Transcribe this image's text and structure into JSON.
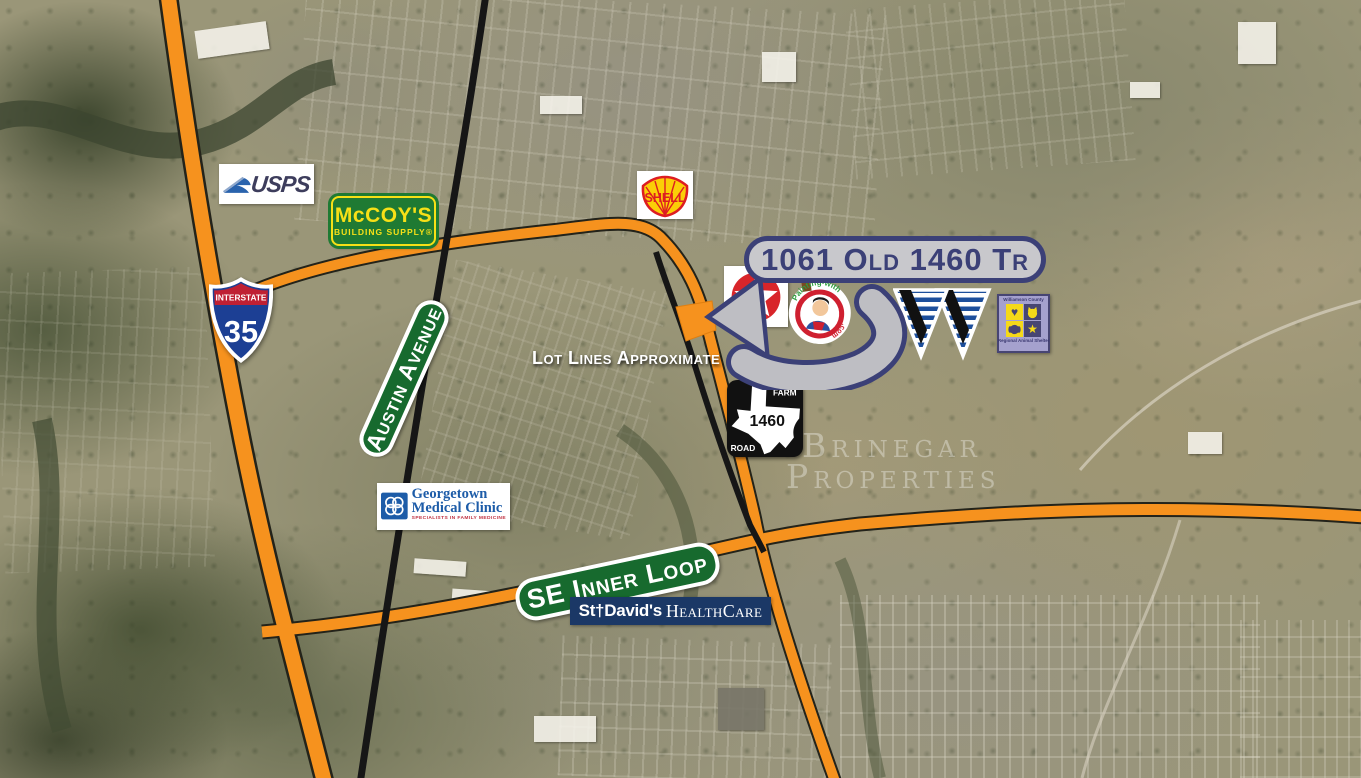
{
  "callout": {
    "label": "1061 Old 1460 Tr"
  },
  "annotations": {
    "lot_lines": "Lot Lines Approximate",
    "watermark_line1": "Brinegar",
    "watermark_line2": "Properties"
  },
  "road_signs": {
    "interstate_35": {
      "header": "INTERSTATE",
      "number": "35"
    },
    "farm_road_1460": {
      "top": "FARM",
      "number": "1460",
      "bottom": "ROAD"
    },
    "austin_avenue": {
      "label": "Austin Avenue"
    },
    "se_inner_loop": {
      "label": "SE Inner Loop"
    }
  },
  "businesses": {
    "usps": {
      "label": "USPS"
    },
    "mccoys": {
      "name": "McCOY'S",
      "tagline": "BUILDING SUPPLY®"
    },
    "shell": {
      "label": "SHELL"
    },
    "texaco": {
      "letter": "T"
    },
    "painting": {
      "arc_top": "Painting-with",
      "arc_side": ".com"
    },
    "georgetown_medical": {
      "line1": "Georgetown",
      "line2": "Medical Clinic",
      "tagline": "SPECIALISTS IN FAMILY MEDICINE"
    },
    "st_davids": {
      "name": "St†David's",
      "suffix": "HealthCare"
    },
    "animal_shelter": {
      "header": "Williamson County",
      "footer": "Regional Animal Shelter"
    }
  },
  "colors": {
    "highway_orange": "#F6921E",
    "navy": "#3B4077",
    "arrow_gray": "#BEBEC3",
    "sign_green": "#176A2E",
    "shell_yellow": "#FBCE07",
    "shell_red": "#DD1D21",
    "texaco_red": "#D8252A",
    "mccoys_green": "#1F7A33",
    "mccoys_yellow": "#F7E017",
    "usps_blue": "#2A63AD",
    "clinic_blue": "#1D5CA8",
    "st_davids_navy": "#1B3866",
    "shelter_purple": "#474573",
    "shelter_yellow": "#F5D919",
    "interstate_blue": "#1C3F94",
    "interstate_red": "#BF2033"
  }
}
